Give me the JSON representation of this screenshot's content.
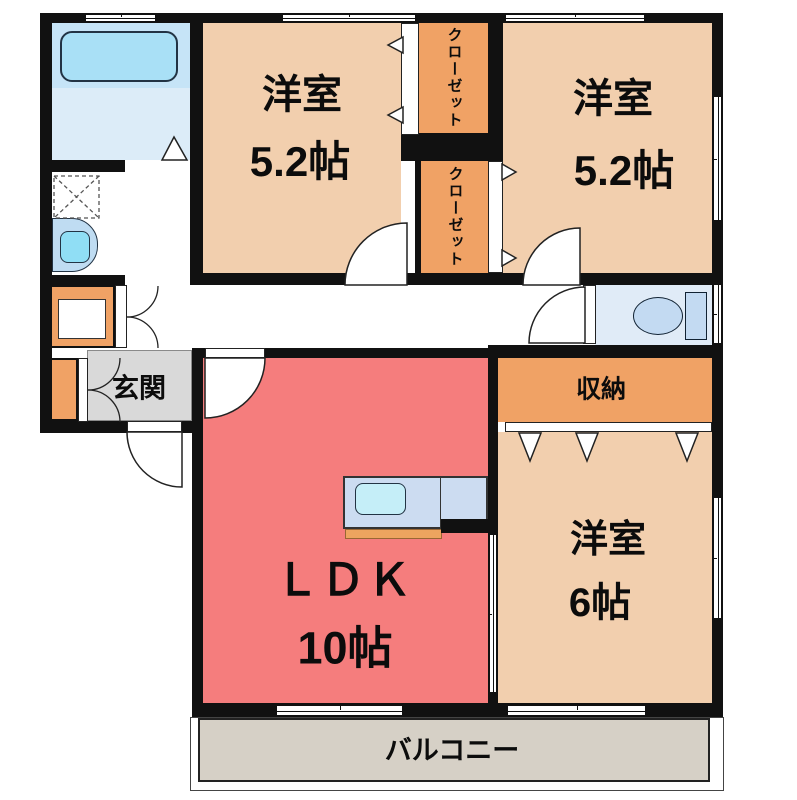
{
  "rooms": {
    "bedroom_left": {
      "name": "洋室",
      "size": "5.2帖"
    },
    "bedroom_right": {
      "name": "洋室",
      "size": "5.2帖"
    },
    "bedroom_south": {
      "name": "洋室",
      "size": "6帖"
    },
    "ldk": {
      "name": "ＬＤＫ",
      "size": "10帖"
    },
    "entrance": {
      "name": "玄関"
    },
    "storage": {
      "name": "収納"
    },
    "closet_top": {
      "name": "クローゼット"
    },
    "closet_bottom": {
      "name": "クローゼット"
    },
    "balcony": {
      "name": "バルコニー"
    }
  },
  "fixtures": {
    "bathtub": "bathtub",
    "washing_machine": "washing-machine-space",
    "vanity": "vanity-sink",
    "toilet": "toilet",
    "kitchen": "kitchen-counter-with-sink",
    "shoe_cabinet": "shoe-cabinet"
  },
  "colors": {
    "wall": "#111111",
    "bedroom_floor": "#f2cfae",
    "closet_orange": "#f0a265",
    "ldk_red": "#f57d7d",
    "entrance_gray": "#d9d9d9",
    "balcony_gray": "#d6d0c6",
    "bath_blue": "#d9ecf8",
    "fixture_blue": "#c3daf2"
  }
}
